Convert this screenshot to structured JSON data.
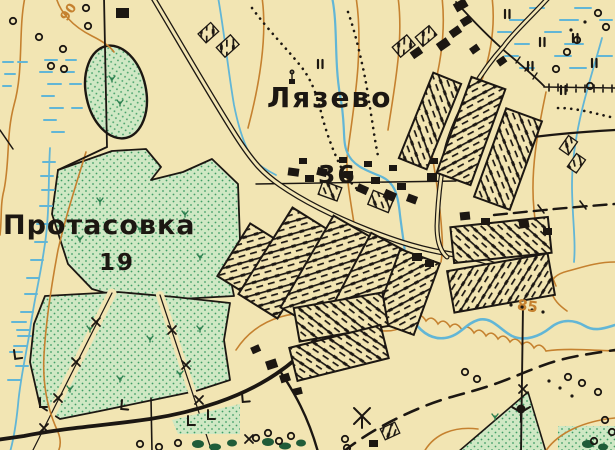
{
  "labels": {
    "lyazevo": {
      "name": "Лязево",
      "households": "36"
    },
    "protasovka": {
      "name": "Протасовка",
      "households": "19"
    },
    "elevation_85": {
      "text": "85"
    },
    "elevation_90": {
      "text": "90"
    }
  },
  "colors": {
    "paper": "#f2e5b3",
    "meadow": "#cfe8c4",
    "meadow-dot": "#3f9e66",
    "meadow-dark": "#2e8050",
    "dark-clump": "#1f5c38",
    "water": "#62b6d6",
    "contour": "#c5812f",
    "ink": "#1c1712"
  }
}
